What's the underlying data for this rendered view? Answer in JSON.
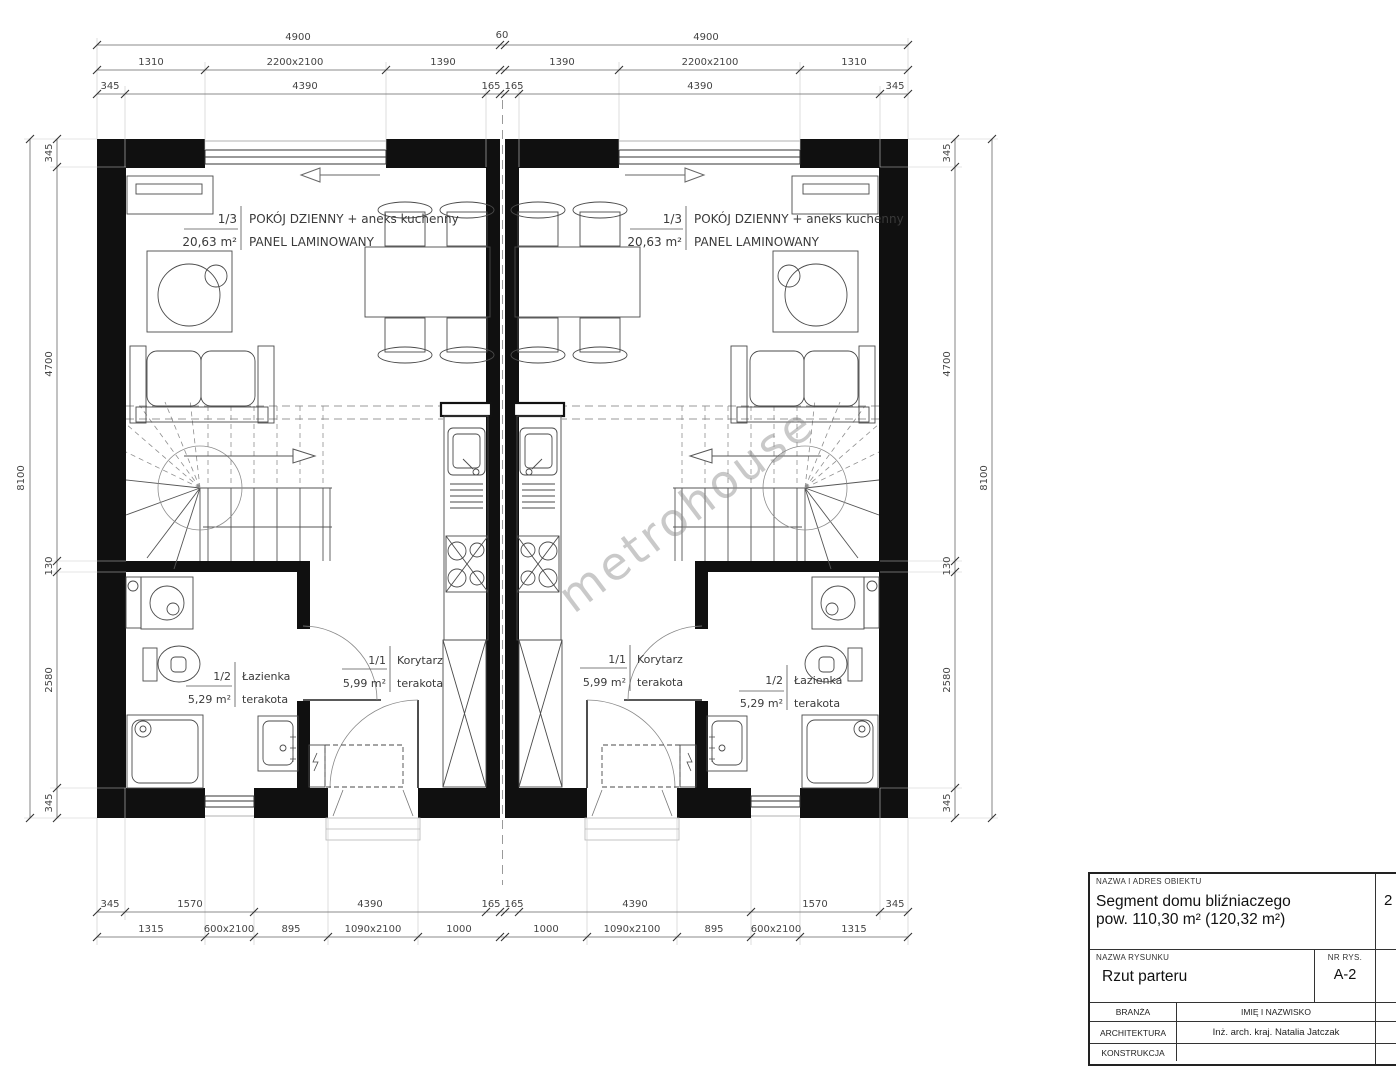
{
  "watermark": "metrohouse",
  "dims": {
    "top1": [
      "4900",
      "60",
      "4900"
    ],
    "top2": [
      "1310",
      "2200x2100",
      "1390",
      "1390",
      "2200x2100",
      "1310"
    ],
    "top3": [
      "345",
      "4390",
      "165",
      "165",
      "4390",
      "345"
    ],
    "bot1": [
      "345",
      "1570",
      "4390",
      "165",
      "165",
      "4390",
      "1570",
      "345"
    ],
    "bot2": [
      "1315",
      "600x2100",
      "895",
      "1090x2100",
      "1000",
      "1000",
      "1090x2100",
      "895",
      "600x2100",
      "1315"
    ],
    "overall": "8100",
    "vert": [
      "345",
      "4700",
      "130",
      "2580",
      "345"
    ]
  },
  "rooms": {
    "living": {
      "num": "1/3",
      "name": "POKÓJ DZIENNY + aneks kuchenny",
      "area": "20,63 m²",
      "finish": "PANEL LAMINOWANY"
    },
    "bath": {
      "num": "1/2",
      "name": "Łazienka",
      "area": "5,29 m²",
      "finish": "terakota"
    },
    "hall": {
      "num": "1/1",
      "name": "Korytarz",
      "area": "5,99 m²",
      "finish": "terakota"
    }
  },
  "title_block": {
    "object_label": "NAZWA I ADRES OBIEKTU",
    "object_name": "Segment domu bliźniaczego",
    "object_area": "pow. 110,30 m² (120,32 m²)",
    "drawing_label": "NAZWA RYSUNKU",
    "drawing_name": "Rzut parteru",
    "number_label": "NR RYS.",
    "number": "A-2",
    "branch_label": "BRANŻA",
    "person_label": "IMIĘ I NAZWISKO",
    "row_architecture": "ARCHITEKTURA",
    "architect": "Inż. arch. kraj. Natalia Jatczak",
    "row_construction": "KONSTRUKCJA",
    "partial_right": "2"
  }
}
